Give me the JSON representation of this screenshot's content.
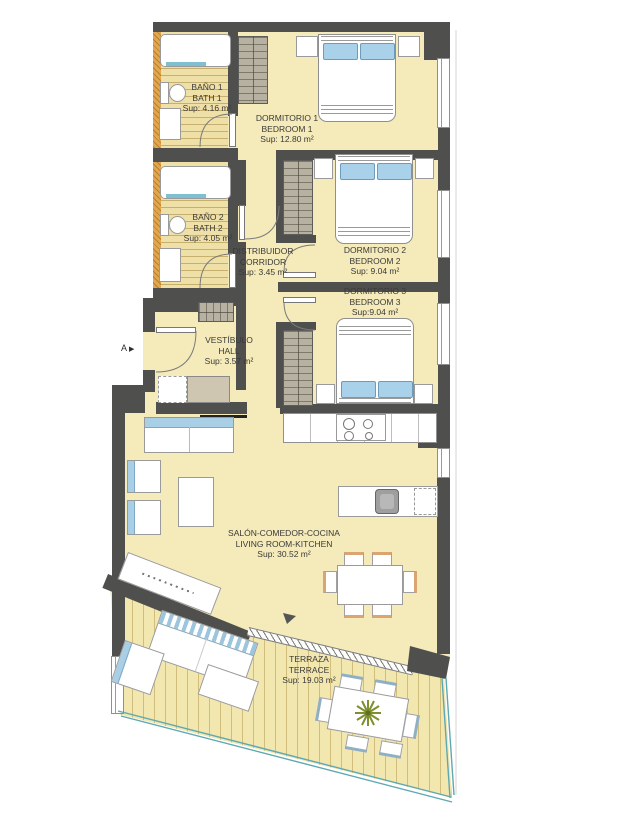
{
  "plan_title": "apartment-floor-plan",
  "rooms": {
    "bano1": {
      "name_primary": "BAÑO 1",
      "name_secondary": "BATH 1",
      "area": "Sup: 4.16 m²"
    },
    "dormitorio1": {
      "name_primary": "DORMITORIO 1",
      "name_secondary": "BEDROOM 1",
      "area": "Sup: 12.80 m²"
    },
    "bano2": {
      "name_primary": "BAÑO 2",
      "name_secondary": "BATH 2",
      "area": "Sup: 4.05 m²"
    },
    "distribuidor": {
      "name_primary": "DISTRIBUIDOR",
      "name_secondary": "CORRIDOR",
      "area": "Sup: 3.45 m²"
    },
    "dormitorio2": {
      "name_primary": "DORMITORIO 2",
      "name_secondary": "BEDROOM 2",
      "area": "Sup: 9.04 m²"
    },
    "dormitorio3": {
      "name_primary": "DORMITORIO 3",
      "name_secondary": "BEDROOM 3",
      "area": "Sup:9.04 m²"
    },
    "vestibulo": {
      "name_primary": "VESTÍBULO",
      "name_secondary": "HALL",
      "area": "Sup: 3.57 m²"
    },
    "salon": {
      "name_primary": "SALÓN-COMEDOR-COCINA",
      "name_secondary": "LIVING ROOM-KITCHEN",
      "area": "Sup: 30.52 m²"
    },
    "terraza": {
      "name_primary": "TERRAZA",
      "name_secondary": "TERRACE",
      "area": "Sup: 19.03 m²"
    }
  },
  "marker": {
    "label": "A",
    "arrow": "▶"
  },
  "colors": {
    "wall": "#4f4f4d",
    "floor": "#f5eaba",
    "bath_floor": "#efe0a8",
    "terrace_floor": "#f3e7b0",
    "wood_wall": "#e2a64f",
    "accent_blue": "#a9d2ea",
    "railing_teal": "#5fa8b2",
    "wardrobe_gray": "#b7b1a2",
    "plant_green": "#7e8f2f",
    "label_text": "#3a3a3a"
  }
}
